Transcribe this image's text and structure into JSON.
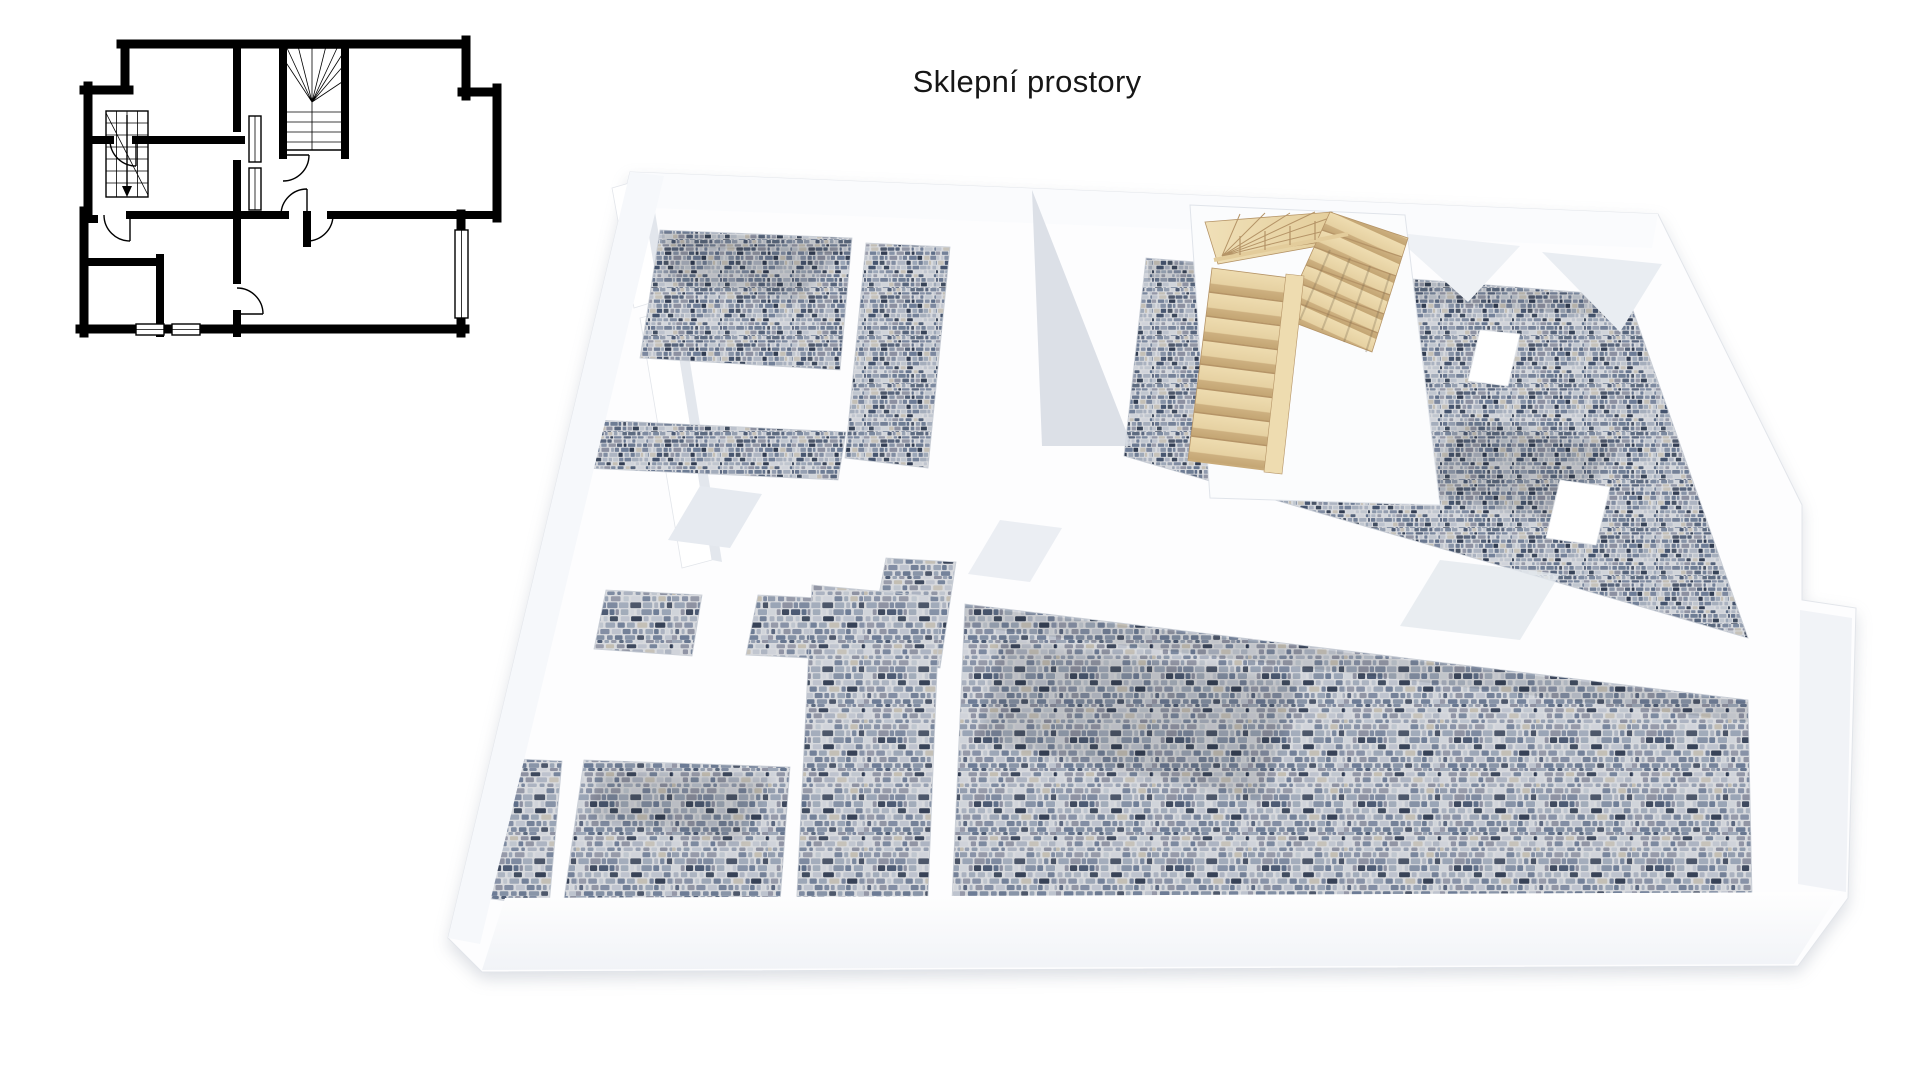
{
  "title": "Sklepní prostory",
  "colors": {
    "page_bg": "#ffffff",
    "plan_ink": "#000000",
    "wall_white": "#fdfdfe",
    "wall_shade": "#e4e8ee",
    "band_shade": "#f2f4f8",
    "wood_light": "#eedcb0",
    "wood_mid": "#e3cc9b",
    "wood_dark": "#c9ab7a",
    "wood_line": "#b59467",
    "stone_base": "#d8dade",
    "shadow": "#9aa2b0",
    "stone_palette": [
      "#2e3a50",
      "#45546e",
      "#5d6d88",
      "#76839b",
      "#8e99ac",
      "#a6aebd",
      "#bcc2cd",
      "#cfd3da",
      "#98a3b4",
      "#6b7a94",
      "#c2bdb2",
      "#8b8fa0"
    ]
  }
}
